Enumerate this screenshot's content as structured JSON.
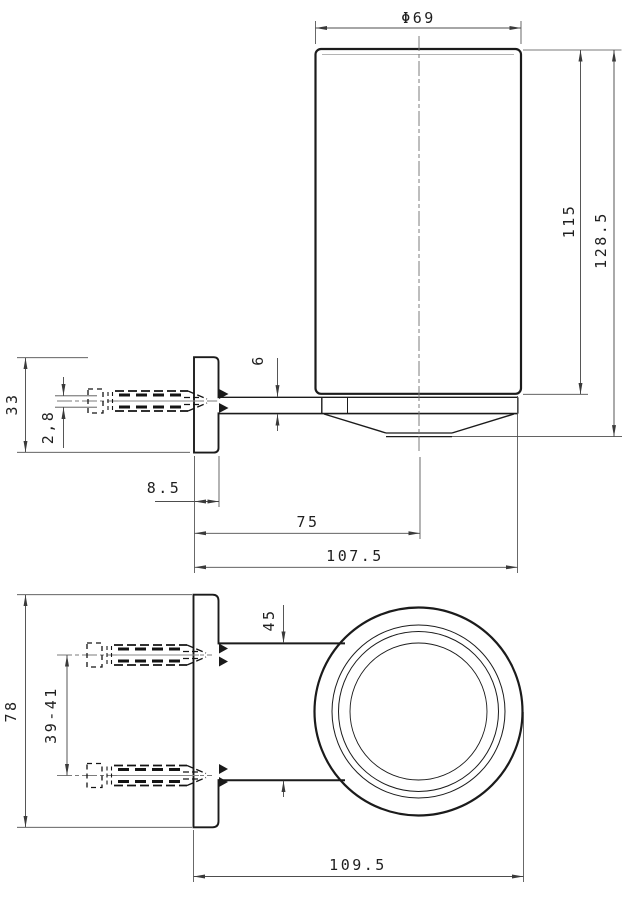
{
  "drawing": {
    "title": "tumbler-holder-technical-drawing",
    "units": "mm",
    "colors": {
      "background": "#ffffff",
      "part_line": "#1b1b1b",
      "dimension_line": "#4d4d4d",
      "centerline": "#7b7b7b",
      "text": "#1f1f1f"
    },
    "views": {
      "side_view": "side elevation",
      "plan_view": "top view"
    },
    "labels": {
      "diameter": "Φ69",
      "cup_height": "115",
      "overall_height": "128.5",
      "arm_thickness": "6",
      "screw_diameter": "2,8",
      "plate_height": "33",
      "plate_thickness": "8.5",
      "wall_to_cup_center": "75",
      "wall_to_cup_edge": "107.5",
      "plate_width": "78",
      "screw_hole_spacing": "39-41",
      "arm_width": "45",
      "overall_depth": "109.5"
    }
  }
}
